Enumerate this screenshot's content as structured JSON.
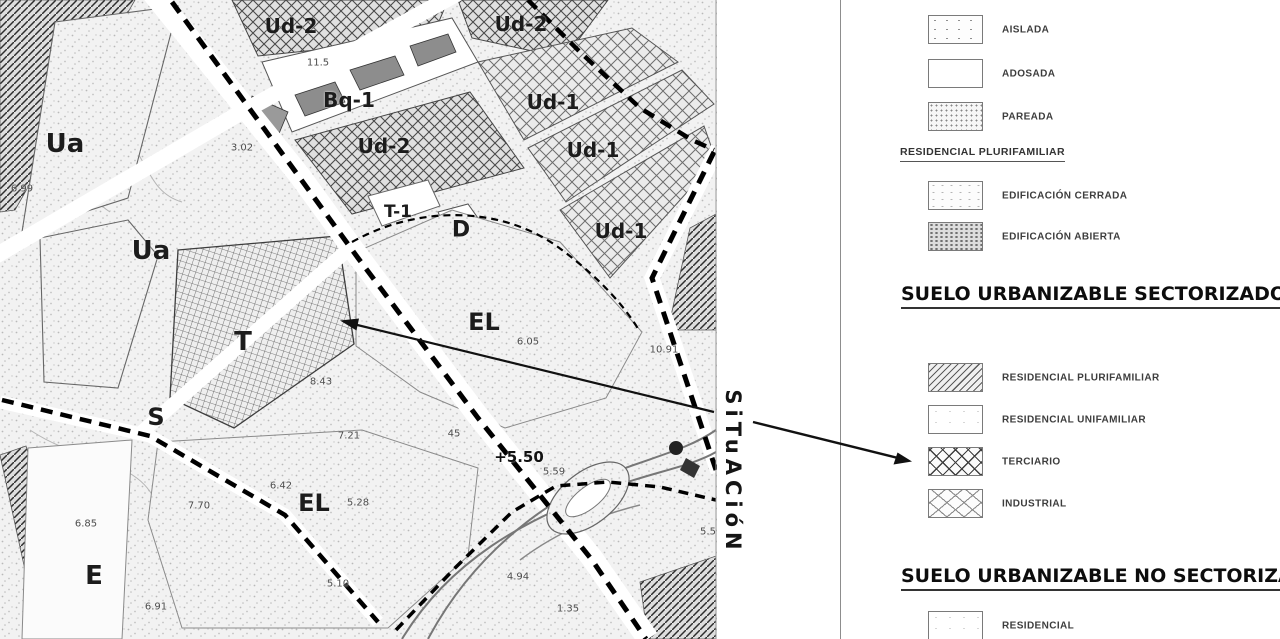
{
  "map": {
    "situacion_label": "SiTuACióN",
    "zone_labels": [
      {
        "text": "Ua"
      },
      {
        "text": "Ud-2"
      },
      {
        "text": "Ud-2"
      },
      {
        "text": "Bq-1"
      },
      {
        "text": "Ud-2"
      },
      {
        "text": "Ud-1"
      },
      {
        "text": "Ud-1"
      },
      {
        "text": "T-1"
      },
      {
        "text": "D"
      },
      {
        "text": "Ud-1"
      },
      {
        "text": "Ua"
      },
      {
        "text": "EL"
      },
      {
        "text": "T"
      },
      {
        "text": "S"
      },
      {
        "text": "EL"
      },
      {
        "text": "E"
      }
    ],
    "spot_elevations": [
      {
        "text": "11.5"
      },
      {
        "text": "3.02"
      },
      {
        "text": "6.99"
      },
      {
        "text": "10.91"
      },
      {
        "text": "8.43"
      },
      {
        "text": "7.21"
      },
      {
        "text": "45"
      },
      {
        "text": "+5.50"
      },
      {
        "text": "5.59"
      },
      {
        "text": "6.05"
      },
      {
        "text": "6.42"
      },
      {
        "text": "7.70"
      },
      {
        "text": "5.28"
      },
      {
        "text": "6.85"
      },
      {
        "text": "5.10"
      },
      {
        "text": "4.94"
      },
      {
        "text": "6.91"
      },
      {
        "text": "1.35"
      },
      {
        "text": "5.5"
      }
    ]
  },
  "legend": {
    "sections": [
      {
        "heading": "",
        "items": [
          {
            "label": "AISLADA",
            "pattern": "dots-sparse"
          },
          {
            "label": "ADOSADA",
            "pattern": "plain"
          },
          {
            "label": "PAREADA",
            "pattern": "dots-dense"
          }
        ]
      },
      {
        "heading": "RESIDENCIAL PLURIFAMILIAR",
        "items": [
          {
            "label": "EDIFICACIÓN CERRADA",
            "pattern": "speckle-light"
          },
          {
            "label": "EDIFICACIÓN ABIERTA",
            "pattern": "speckle-dense"
          }
        ]
      },
      {
        "heading": "SUELO URBANIZABLE SECTORIZADO",
        "items": [
          {
            "label": "RESIDENCIAL PLURIFAMILIAR",
            "pattern": "diag-hatch"
          },
          {
            "label": "RESIDENCIAL UNIFAMILIAR",
            "pattern": "plain-light"
          },
          {
            "label": "TERCIARIO",
            "pattern": "cross-x"
          },
          {
            "label": "INDUSTRIAL",
            "pattern": "cross-diamond"
          }
        ]
      },
      {
        "heading": "SUELO URBANIZABLE NO SECTORIZADO",
        "items": [
          {
            "label": "RESIDENCIAL",
            "pattern": "plain-light"
          }
        ]
      }
    ]
  },
  "colors": {
    "ink": "#1a1a1a",
    "paper": "#ffffff",
    "boundary_dash": "#000000"
  }
}
